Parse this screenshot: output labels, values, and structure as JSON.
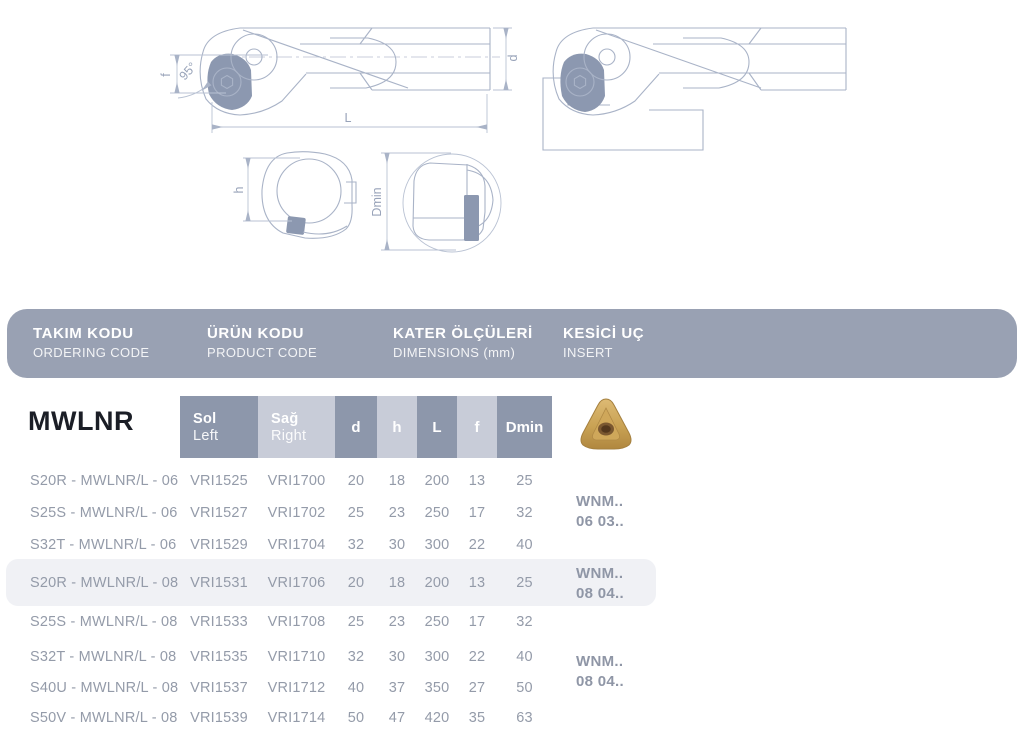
{
  "product": {
    "family": "MWLNR",
    "angle": "95°"
  },
  "header": {
    "columns": [
      {
        "tr": "TAKIM KODU",
        "en": "ORDERING CODE"
      },
      {
        "tr": "ÜRÜN KODU",
        "en": "PRODUCT CODE"
      },
      {
        "tr": "KATER ÖLÇÜLERİ",
        "en": "DIMENSIONS (mm)"
      },
      {
        "tr": "KESİCİ UÇ",
        "en": "INSERT"
      }
    ]
  },
  "drawings": {
    "side_view": {
      "dim_f": "f",
      "angle": "95°",
      "dim_L": "L",
      "dim_d": "d"
    },
    "end_view": {
      "dim_h": "h"
    },
    "bore_view": {
      "dim_dmin": "Dmin"
    }
  },
  "table": {
    "subheaders": {
      "sol1": "Sol",
      "sol2": "Left",
      "sag1": "Sağ",
      "sag2": "Right",
      "d": "d",
      "h": "h",
      "L": "L",
      "f": "f",
      "dmin": "Dmin"
    },
    "rows": [
      {
        "code": "S20R - MWLNR/L - 06",
        "sol": "VRI1525",
        "sag": "VRI1700",
        "d": "20",
        "h": "18",
        "L": "200",
        "f": "13",
        "dmin": "25"
      },
      {
        "code": "S25S - MWLNR/L - 06",
        "sol": "VRI1527",
        "sag": "VRI1702",
        "d": "25",
        "h": "23",
        "L": "250",
        "f": "17",
        "dmin": "32"
      },
      {
        "code": "S32T - MWLNR/L - 06",
        "sol": "VRI1529",
        "sag": "VRI1704",
        "d": "32",
        "h": "30",
        "L": "300",
        "f": "22",
        "dmin": "40"
      },
      {
        "code": "S20R - MWLNR/L - 08",
        "sol": "VRI1531",
        "sag": "VRI1706",
        "d": "20",
        "h": "18",
        "L": "200",
        "f": "13",
        "dmin": "25"
      },
      {
        "code": "S25S - MWLNR/L - 08",
        "sol": "VRI1533",
        "sag": "VRI1708",
        "d": "25",
        "h": "23",
        "L": "250",
        "f": "17",
        "dmin": "32"
      },
      {
        "code": "S32T - MWLNR/L - 08",
        "sol": "VRI1535",
        "sag": "VRI1710",
        "d": "32",
        "h": "30",
        "L": "300",
        "f": "22",
        "dmin": "40"
      },
      {
        "code": "S40U - MWLNR/L - 08",
        "sol": "VRI1537",
        "sag": "VRI1712",
        "d": "40",
        "h": "37",
        "L": "350",
        "f": "27",
        "dmin": "50"
      },
      {
        "code": "S50V - MWLNR/L - 08",
        "sol": "VRI1539",
        "sag": "VRI1714",
        "d": "50",
        "h": "47",
        "L": "420",
        "f": "35",
        "dmin": "63"
      }
    ],
    "insert_groups": [
      {
        "line1": "WNM..",
        "line2": "06 03.."
      },
      {
        "line1": "WNM..",
        "line2": "08 04.."
      },
      {
        "line1": "WNM..",
        "line2": "08 04.."
      }
    ],
    "highlighted_row": "S20R - MWLNR/L - 08"
  },
  "colors": {
    "header_bar": "#99a1b3",
    "cell_dark": "#8d97ab",
    "cell_light": "#c8ccd8",
    "row_text": "#949ba9",
    "highlight_bg": "#f0f1f5",
    "drawing_line": "#a9b3c7",
    "insert_fill": "#8c98b0",
    "insert_gold": "#c9a254",
    "title_text": "#1b1e26"
  }
}
